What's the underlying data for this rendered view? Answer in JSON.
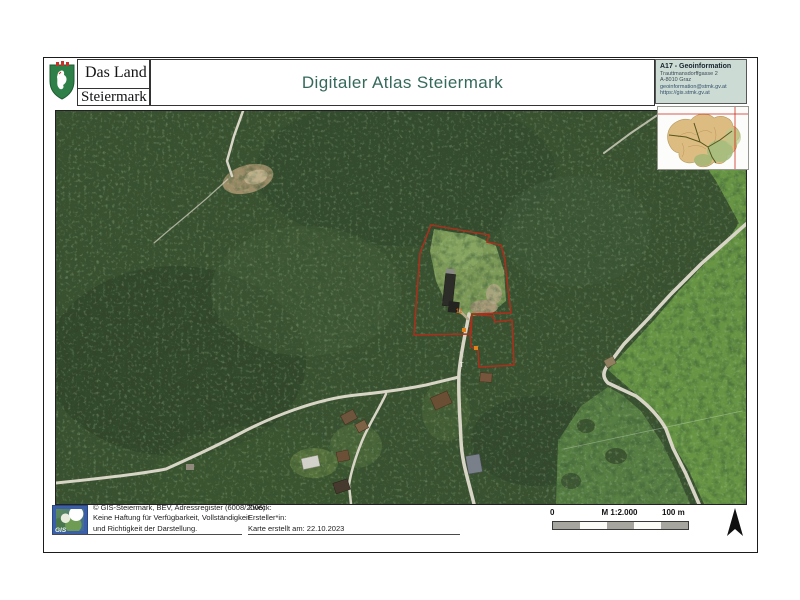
{
  "header": {
    "logo": {
      "line1": "Das Land",
      "line2": "Steiermark"
    },
    "title": "Digitaler Atlas Steiermark",
    "info": {
      "dept": "A17 - Geoinformation",
      "address": "Trauttmansdorffgasse 2",
      "city": "A-8010 Graz",
      "email": "geoinformation@stmk.gv.at",
      "web": "https://gis.stmk.gv.at"
    }
  },
  "map": {
    "labels": {
      "parcel_number": "11",
      "point_t": "T"
    },
    "colors": {
      "parcel_outline": "#a8301d",
      "forest": "#3a5130",
      "meadow": "#679544",
      "road": "#d8d5c7",
      "marker_orange": "#e0821e"
    }
  },
  "footer": {
    "gis_logo": "GIS",
    "copyright": "© GIS-Steiermark, BEV, Adressregister (6008/2006)",
    "disclaimer1": "Keine Haftung für Verfügbarkeit, Vollständigkeit",
    "disclaimer2": "und Richtigkeit der Darstellung.",
    "purpose_label": "Zweck:",
    "creator_label": "Ersteller*in:",
    "created_label": "Karte erstellt am: 22.10.2023",
    "scalebar": {
      "start": "0",
      "scale": "M 1:2.000",
      "end": "100 m"
    }
  }
}
